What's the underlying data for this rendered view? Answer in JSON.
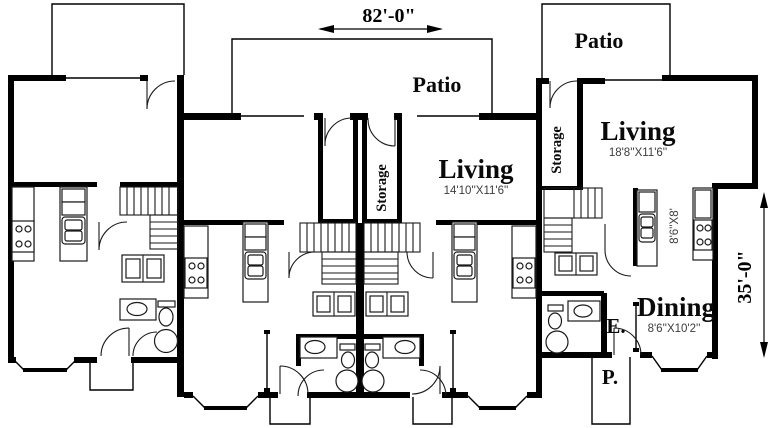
{
  "plan": {
    "type": "fourplex-floor-plan",
    "colors": {
      "wall": "#000000",
      "background": "#ffffff",
      "size_text": "#3c3c3c"
    },
    "dimensions": {
      "width": "82'-0\"",
      "depth": "35'-0\""
    },
    "labels": {
      "patio_center": "Patio",
      "patio_right": "Patio",
      "living_center": "Living",
      "living_center_size": "14'10''X11'6''",
      "living_right": "Living",
      "living_right_size": "18'8''X11'6''",
      "storage_center": "Storage",
      "storage_right": "Storage",
      "kitchen_right_size": "8'6''X8'",
      "dining": "Dining",
      "dining_size": "8'6''X10'2''",
      "entry_abbrev": "E.",
      "porch_abbrev": "P."
    }
  }
}
